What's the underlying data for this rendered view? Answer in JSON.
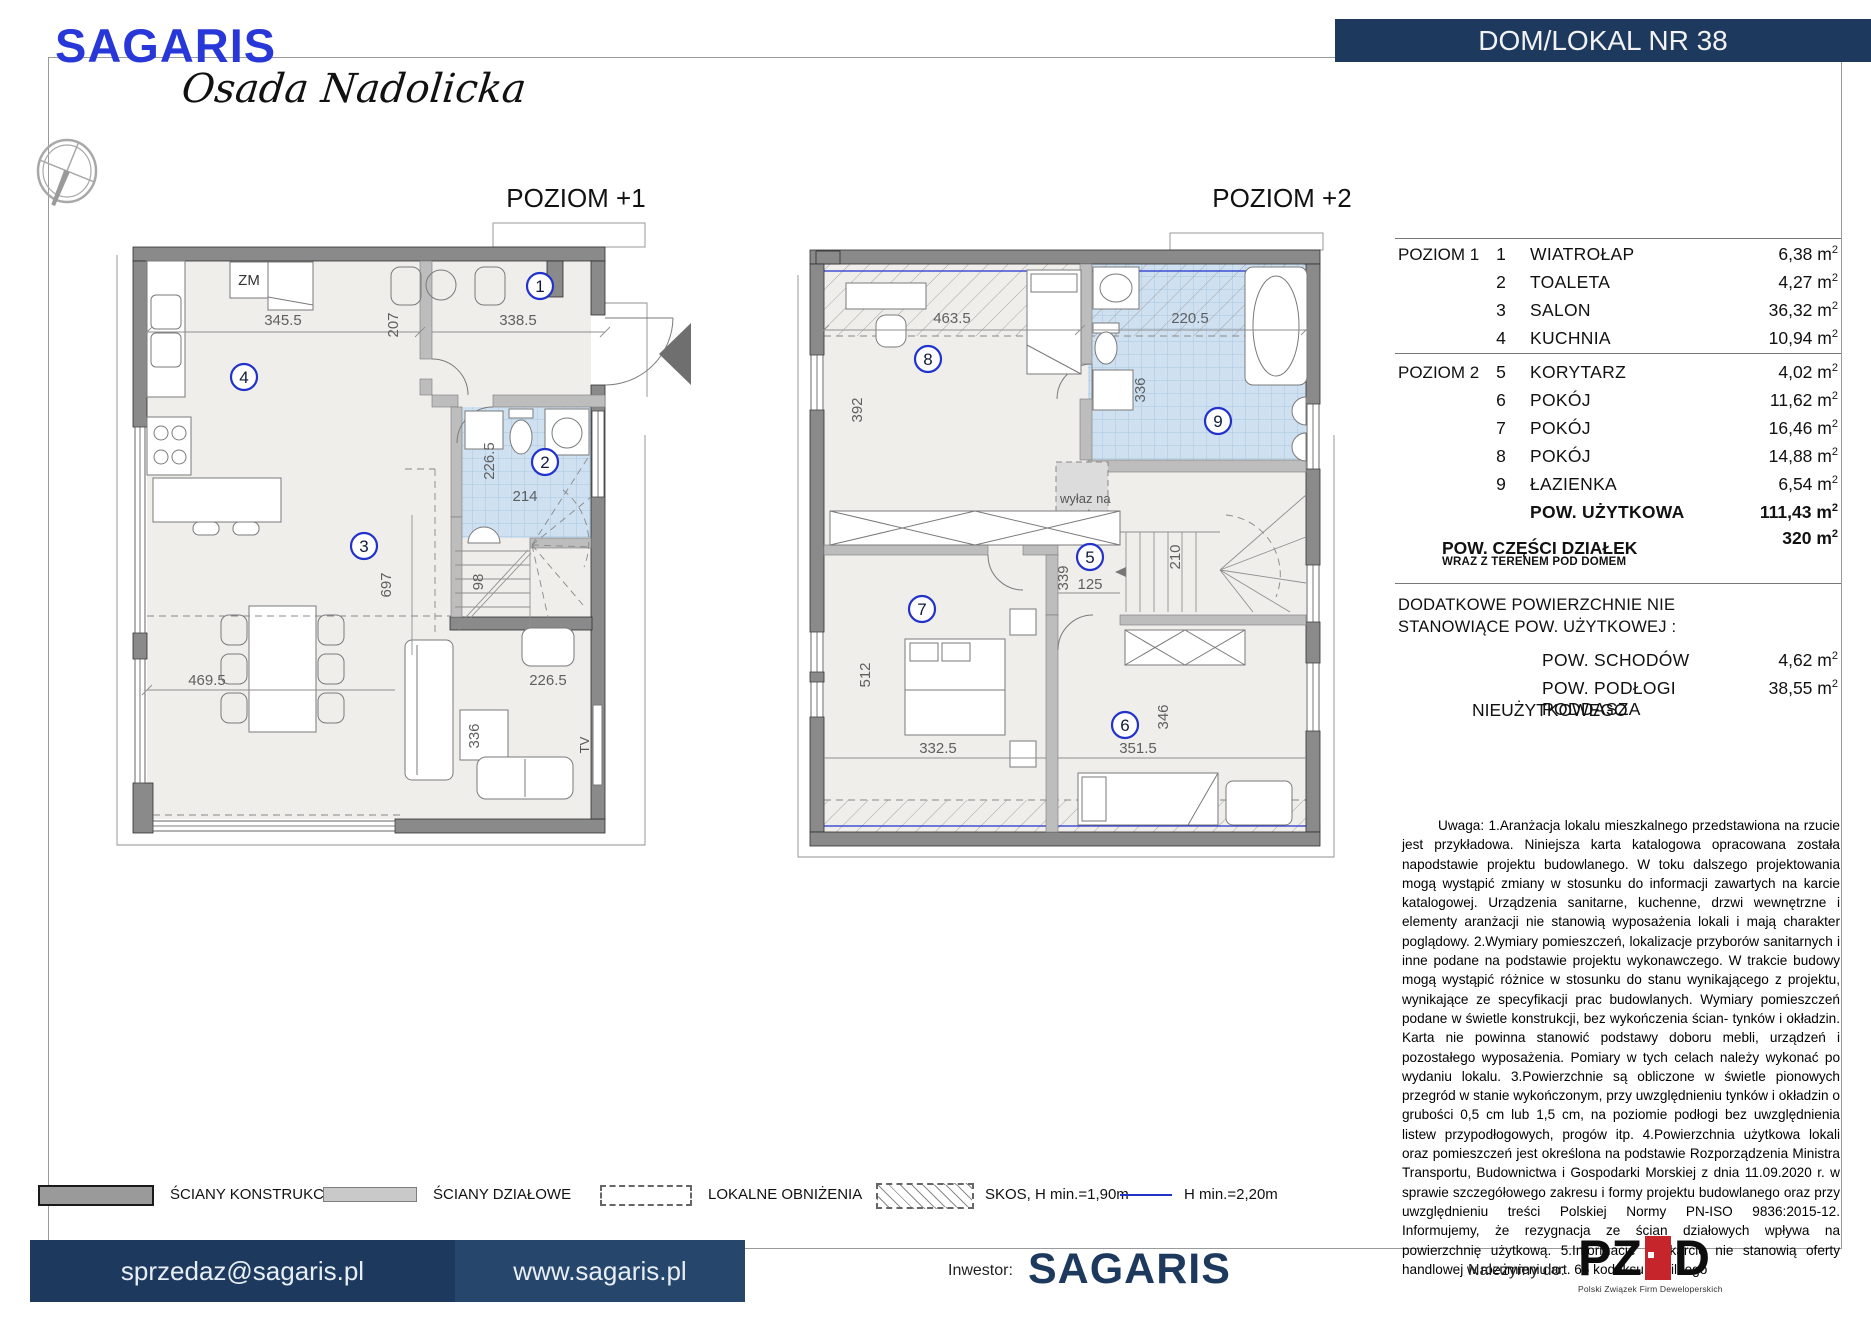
{
  "logo": {
    "brand": "SAGARIS",
    "estate": "Osada Nadolicka"
  },
  "banner": {
    "title": "DOM/LOKAL NR 38"
  },
  "plans": {
    "p1": {
      "title": "POZIOM +1",
      "zm": "ZM",
      "tv": "TV",
      "nums": {
        "n1": "1",
        "n2": "2",
        "n3": "3",
        "n4": "4"
      },
      "dims": {
        "kitchen_w": "345.5",
        "gap": "207",
        "entry_w": "338.5",
        "wc_h": "226.5",
        "wc_w": "214",
        "salon_h": "697",
        "stairs": "98",
        "salon_w": "469.5",
        "chair": "226.5",
        "table": "336"
      }
    },
    "p2": {
      "title": "POZIOM +2",
      "attic_line1": "wyłaz na",
      "attic_line2": "strych",
      "nums": {
        "n5": "5",
        "n6": "6",
        "n7": "7",
        "n8": "8",
        "n9": "9"
      },
      "dims": {
        "r8_w": "463.5",
        "r8_h": "392",
        "bath_w": "220.5",
        "bath_h": "336",
        "corr_h": "339",
        "corr_w": "125",
        "stairs": "210",
        "r7_h": "512",
        "r7_w": "332.5",
        "r6_w": "351.5",
        "r6_h": "346"
      }
    }
  },
  "table": {
    "sections": [
      {
        "label": "POZIOM 1"
      },
      {
        "label": "POZIOM 2"
      }
    ],
    "rows": [
      {
        "num": "1",
        "name": "WIATROŁAP",
        "area": "6,38"
      },
      {
        "num": "2",
        "name": "TOALETA",
        "area": "4,27"
      },
      {
        "num": "3",
        "name": "SALON",
        "area": "36,32"
      },
      {
        "num": "4",
        "name": "KUCHNIA",
        "area": "10,94"
      },
      {
        "num": "5",
        "name": "KORYTARZ",
        "area": "4,02"
      },
      {
        "num": "6",
        "name": "POKÓJ",
        "area": "11,62"
      },
      {
        "num": "7",
        "name": "POKÓJ",
        "area": "16,46"
      },
      {
        "num": "8",
        "name": "POKÓJ",
        "area": "14,88"
      },
      {
        "num": "9",
        "name": "ŁAZIENKA",
        "area": "6,54"
      }
    ],
    "total_label": "POW. UŻYTKOWA",
    "total_area": "111,43",
    "plot_label": "POW. CZĘŚCI DZIAŁEK",
    "plot_sub": "WRAZ Z TERENEM POD DOMEM",
    "plot_area": "320",
    "extra_h1": "DODATKOWE POWIERZCHNIE NIE",
    "extra_h2": "STANOWIĄCE POW. UŻYTKOWEJ :",
    "stairs_label": "POW. SCHODÓW",
    "stairs_area": "4,62",
    "attic_label1": "POW. PODŁOGI PODDASZA",
    "attic_label2": "NIEUŻYTKOWEGO",
    "attic_area": "38,55",
    "unit": "m",
    "sup": "2"
  },
  "notes": "Uwaga: 1.Aranżacja lokalu mieszkalnego przedstawiona na rzucie jest przykładowa. Niniejsza karta katalogowa opracowana została napodstawie projektu budowlanego. W toku dalszego projektowania mogą wystąpić zmiany w stosunku do informacji zawartych na karcie katalogowej. Urządzenia sanitarne, kuchenne, drzwi wewnętrzne i elementy aranżacji nie stanowią wyposażenia lokali i mają charakter poglądowy. 2.Wymiary pomieszczeń, lokalizacje przyborów sanitarnych i inne podane na podstawie projektu wykonawczego. W trakcie budowy mogą wystąpić różnice w stosunku do stanu wynikającego z projektu, wynikające ze specyfikacji prac budowlanych. Wymiary pomieszczeń podane w świetle konstrukcji, bez wykończenia ścian- tynków i okładzin. Karta nie powinna stanowić podstawy doboru mebli, urządzeń i pozostałego wyposażenia. Pomiary w tych celach należy wykonać po wydaniu lokalu. 3.Powierzchnie są obliczone w świetle pionowych przegród w stanie wykończonym, przy uwzględnieniu tynków i okładzin o grubości 0,5 cm lub 1,5 cm, na poziomie podłogi bez uwzględnienia listew przypodłogowych, progów itp. 4.Powierzchnia użytkowa lokali oraz pomieszczeń jest określona na podstawie Rozporządzenia Ministra Transportu, Budownictwa i Gospodarki Morskiej z dnia 11.09.2020 r. w sprawie szczegółowego zakresu i formy projektu budowlanego oraz przy uwzględnieniu treści Polskiej Normy PN-ISO 9836:2015-12. Informujemy, że rezygnacja ze ścian działowych wpływa na powierzchnię użytkową. 5.Informacje na karcie nie stanowią oferty handlowej w rozumieniu art. 66 kodeksu cywilnego",
  "legend": {
    "konstrukcyjne": "ŚCIANY KONSTRUKCYJNE",
    "dzialowe": "ŚCIANY DZIAŁOWE",
    "obnizenia": "LOKALNE OBNIŻENIA",
    "skos": "SKOS, H min.=1,90m",
    "hline": "H min.=2,20m"
  },
  "footer": {
    "email": "sprzedaz@sagaris.pl",
    "web": "www.sagaris.pl",
    "investor_label": "Inwestor:",
    "investor": "SAGARIS",
    "member_label": "Należymy do:",
    "pzfd_pz": "PZ",
    "pzfd_d": "D",
    "pzfd_caption": "Polski Związek Firm Deweloperskich"
  },
  "colors": {
    "navy": "#1d3a5e",
    "logo_blue": "#2837d8",
    "accent_blue": "#2233cc"
  }
}
